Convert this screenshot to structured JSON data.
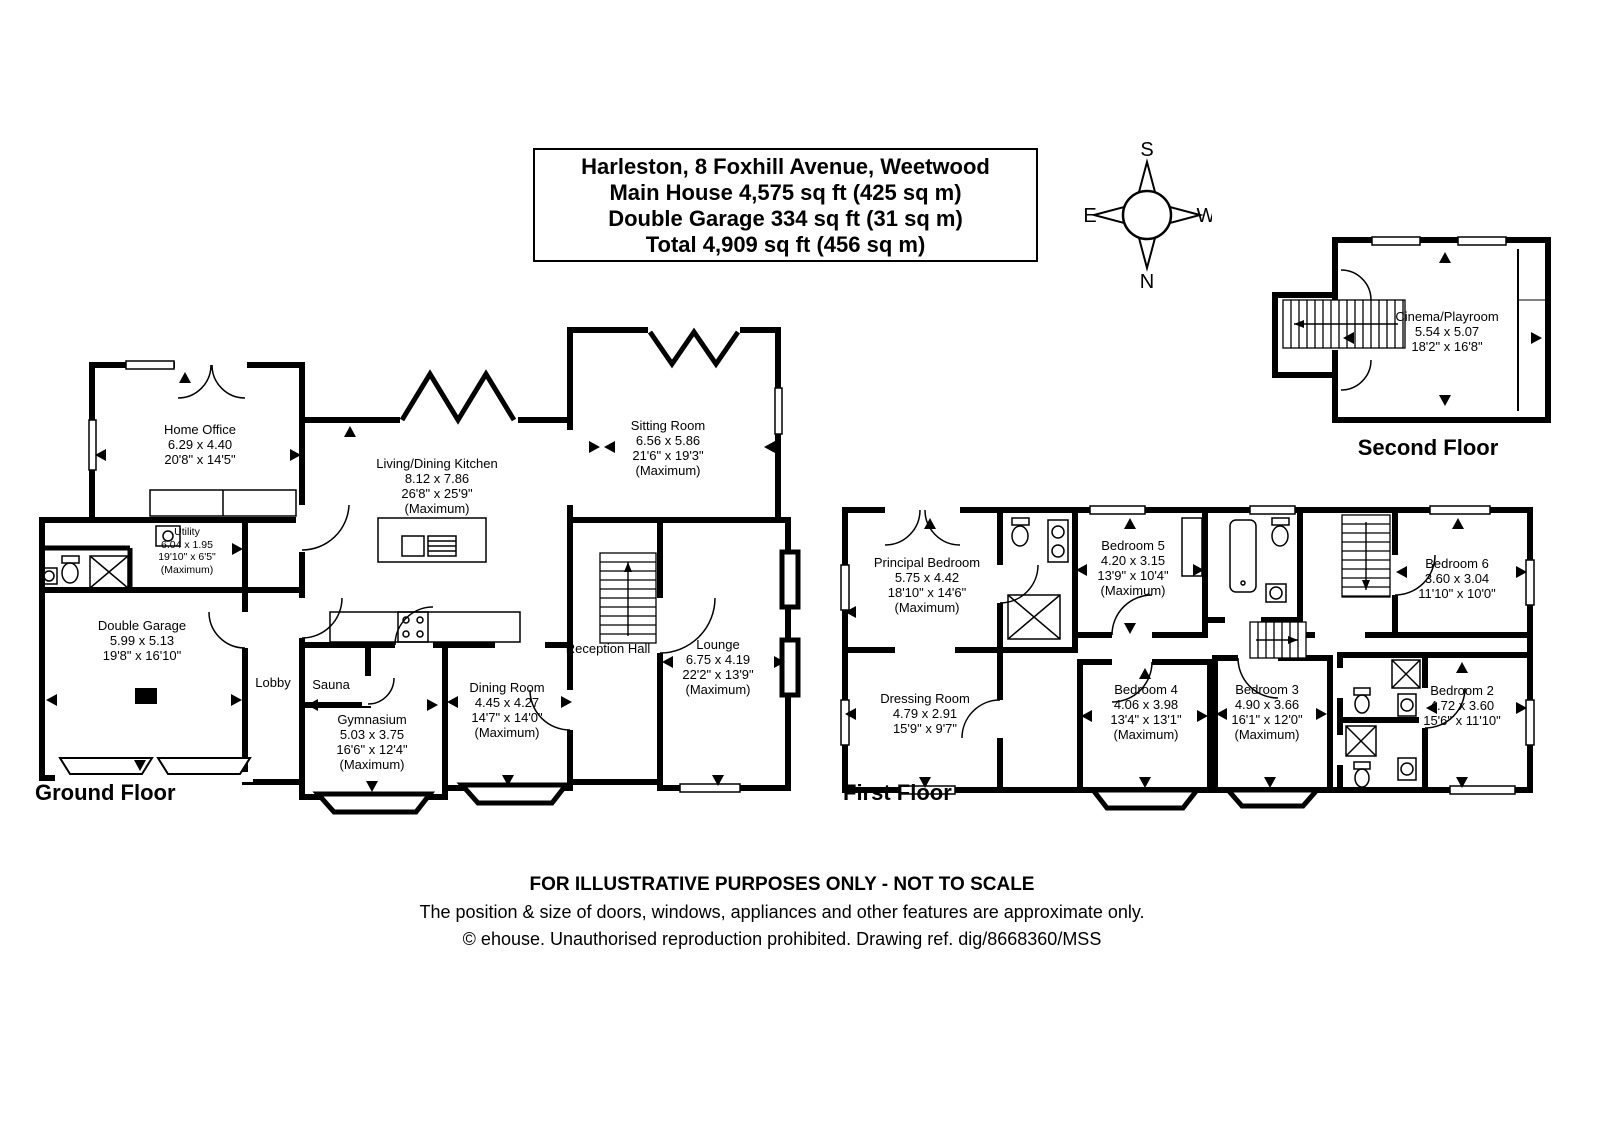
{
  "title_box": {
    "line1": "Harleston, 8 Foxhill Avenue, Weetwood",
    "line2": "Main House 4,575 sq ft (425 sq m)",
    "line3": "Double Garage 334 sq ft (31 sq m)",
    "line4": "Total 4,909 sq ft (456 sq m)"
  },
  "compass": {
    "top": "S",
    "bottom": "N",
    "left": "E",
    "right": "W"
  },
  "floors": {
    "ground": {
      "label": "Ground Floor",
      "rooms": [
        {
          "name": "Home Office",
          "metric": "6.29 x 4.40",
          "imperial": "20'8\" x 14'5\""
        },
        {
          "name": "Utility",
          "metric": "6.04 x 1.95",
          "imperial": "19'10\" x 6'5\"",
          "note": "(Maximum)"
        },
        {
          "name": "Double Garage",
          "metric": "5.99 x 5.13",
          "imperial": "19'8\" x 16'10\""
        },
        {
          "name": "Lobby"
        },
        {
          "name": "Sauna"
        },
        {
          "name": "Gymnasium",
          "metric": "5.03 x 3.75",
          "imperial": "16'6\" x 12'4\"",
          "note": "(Maximum)"
        },
        {
          "name": "Living/Dining Kitchen",
          "metric": "8.12 x 7.86",
          "imperial": "26'8\" x 25'9\"",
          "note": "(Maximum)"
        },
        {
          "name": "Sitting Room",
          "metric": "6.56 x 5.86",
          "imperial": "21'6\" x 19'3\"",
          "note": "(Maximum)"
        },
        {
          "name": "Dining Room",
          "metric": "4.45 x 4.27",
          "imperial": "14'7\" x 14'0\"",
          "note": "(Maximum)"
        },
        {
          "name": "Reception Hall"
        },
        {
          "name": "Lounge",
          "metric": "6.75 x 4.19",
          "imperial": "22'2\" x 13'9\"",
          "note": "(Maximum)"
        }
      ]
    },
    "first": {
      "label": "First Floor",
      "rooms": [
        {
          "name": "Principal Bedroom",
          "metric": "5.75 x 4.42",
          "imperial": "18'10\" x 14'6\"",
          "note": "(Maximum)"
        },
        {
          "name": "Dressing Room",
          "metric": "4.79 x 2.91",
          "imperial": "15'9\" x 9'7\""
        },
        {
          "name": "Bedroom 5",
          "metric": "4.20 x 3.15",
          "imperial": "13'9\" x 10'4\"",
          "note": "(Maximum)"
        },
        {
          "name": "Bedroom 6",
          "metric": "3.60 x 3.04",
          "imperial": "11'10\" x 10'0\""
        },
        {
          "name": "Bedroom 4",
          "metric": "4.06 x 3.98",
          "imperial": "13'4\" x 13'1\"",
          "note": "(Maximum)"
        },
        {
          "name": "Bedroom 3",
          "metric": "4.90 x 3.66",
          "imperial": "16'1\" x 12'0\"",
          "note": "(Maximum)"
        },
        {
          "name": "Bedroom 2",
          "metric": "4.72 x 3.60",
          "imperial": "15'6\" x 11'10\""
        }
      ]
    },
    "second": {
      "label": "Second Floor",
      "rooms": [
        {
          "name": "Cinema/Playroom",
          "metric": "5.54 x 5.07",
          "imperial": "18'2\" x 16'8\""
        }
      ]
    }
  },
  "footer": {
    "line1": "FOR ILLUSTRATIVE PURPOSES ONLY - NOT TO SCALE",
    "line2": "The position & size of doors, windows, appliances and other features are approximate only.",
    "line3": "© ehouse. Unauthorised reproduction prohibited. Drawing ref. dig/8668360/MSS"
  },
  "colors": {
    "walls": "#000000",
    "background": "#ffffff"
  }
}
